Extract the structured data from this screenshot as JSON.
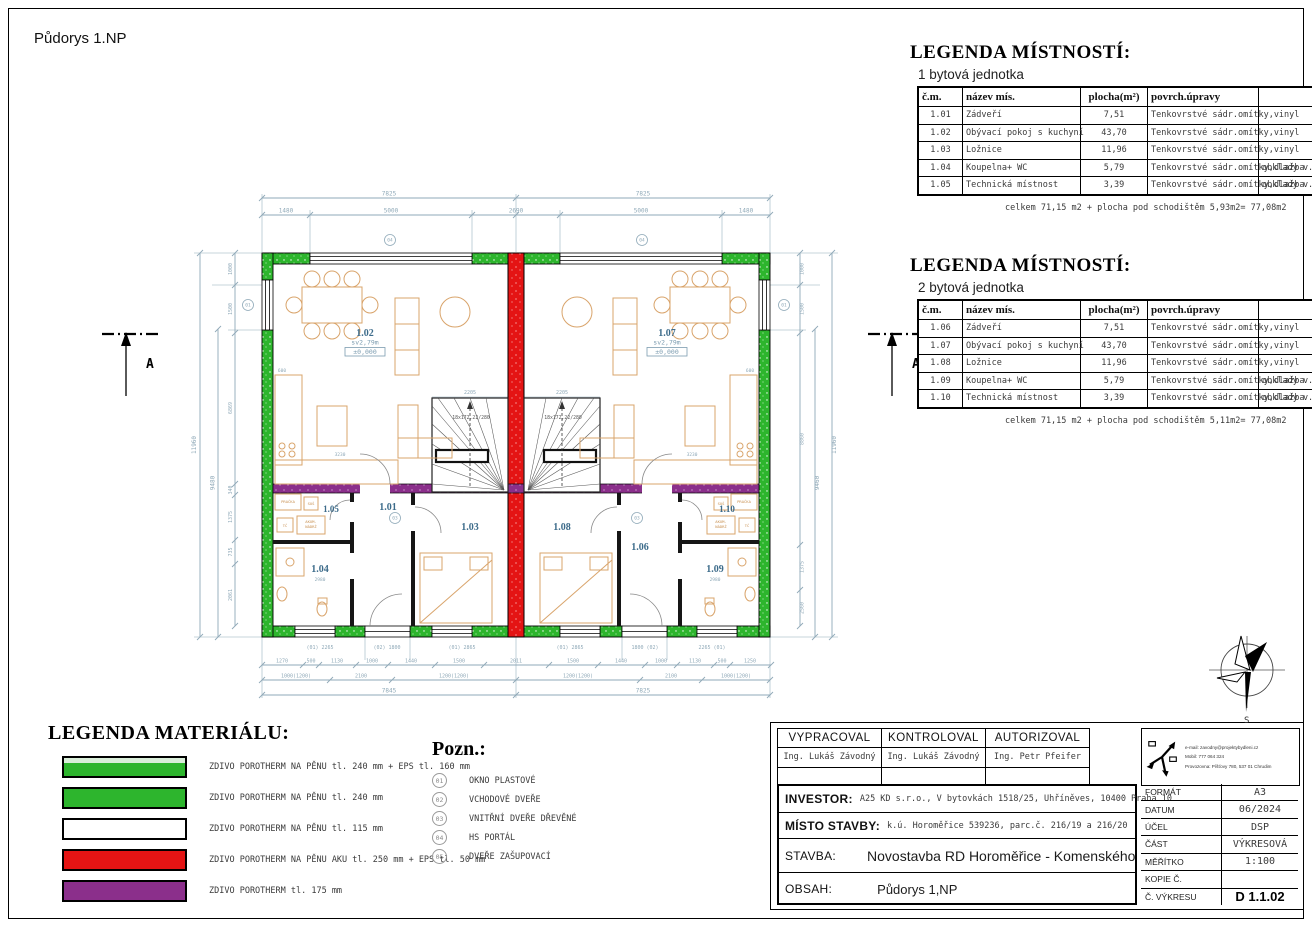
{
  "page": {
    "title": "Půdorys 1.NP"
  },
  "legend_rooms_1": {
    "title": "LEGENDA MÍSTNOSTÍ:",
    "subtitle": "1 bytová jednotka",
    "headers": [
      "č.m.",
      "název mís.",
      "plocha(m²)",
      "povrch.úpravy",
      ""
    ],
    "rows": [
      [
        "1.01",
        "Zádveří",
        "7,51",
        "Tenkovrstvé sádr.omítky,vinyl",
        ""
      ],
      [
        "1.02",
        "Obývací pokoj s kuchyní",
        "43,70",
        "Tenkovrstvé sádr.omítky,vinyl",
        ""
      ],
      [
        "1.03",
        "Ložnice",
        "11,96",
        "Tenkovrstvé sádr.omítky,vinyl",
        ""
      ],
      [
        "1.04",
        "Koupelna+ WC",
        "5,79",
        "Tenkovrstvé sádr.omítky,dlažba",
        "obklady v.2m"
      ],
      [
        "1.05",
        "Technická místnost",
        "3,39",
        "Tenkovrstvé sádr.omítky,dlažba",
        "obklady v.2m"
      ]
    ],
    "total": "celkem 71,15 m2 + plocha pod schodištěm 5,93m2= 77,08m2"
  },
  "legend_rooms_2": {
    "title": "LEGENDA MÍSTNOSTÍ:",
    "subtitle": "2 bytová jednotka",
    "headers": [
      "č.m.",
      "název mís.",
      "plocha(m²)",
      "povrch.úpravy",
      ""
    ],
    "rows": [
      [
        "1.06",
        "Zádveří",
        "7,51",
        "Tenkovrstvé sádr.omítky,vinyl",
        ""
      ],
      [
        "1.07",
        "Obývací pokoj s kuchyní",
        "43,70",
        "Tenkovrstvé sádr.omítky,vinyl",
        ""
      ],
      [
        "1.08",
        "Ložnice",
        "11,96",
        "Tenkovrstvé sádr.omítky,vinyl",
        ""
      ],
      [
        "1.09",
        "Koupelna+ WC",
        "5,79",
        "Tenkovrstvé sádr.omítky,dlažba",
        "obklady v.2m"
      ],
      [
        "1.10",
        "Technická místnost",
        "3,39",
        "Tenkovrstvé sádr.omítky,dlažba",
        "obklady v.2m"
      ]
    ],
    "total": "celkem 71,15 m2 + plocha pod schodištěm 5,11m2= 77,08m2"
  },
  "legend_materials": {
    "title": "LEGENDA MATERIÁLU:",
    "items": [
      {
        "color": "#2db52d",
        "eps_color": "#d9eed9",
        "label": "ZDIVO POROTHERM NA PĚNU tl. 240 mm + EPS tl. 160 mm"
      },
      {
        "color": "#2db52d",
        "label": "ZDIVO POROTHERM NA PĚNU tl. 240 mm"
      },
      {
        "color": "#ffffff",
        "label": "ZDIVO POROTHERM NA PĚNU tl. 115 mm"
      },
      {
        "color": "#e41414",
        "label": "ZDIVO POROTHERM NA PĚNU AKU tl. 250 mm + EPS tl. 50 mm"
      },
      {
        "color": "#8b2f8b",
        "label": "ZDIVO POROTHERM tl. 175 mm"
      }
    ]
  },
  "notes": {
    "title": "Pozn.:",
    "items": [
      {
        "num": "01",
        "label": "OKNO PLASTOVÉ"
      },
      {
        "num": "02",
        "label": "VCHODOVÉ DVEŘE"
      },
      {
        "num": "03",
        "label": "VNITŘNÍ DVEŘE DŘEVĚNÉ"
      },
      {
        "num": "04",
        "label": "HS PORTÁL"
      },
      {
        "num": "05",
        "label": "DVEŘE ZAŠUPOVACÍ"
      }
    ]
  },
  "title_block": {
    "vypracoval_label": "VYPRACOVAL",
    "vypracoval": "Ing. Lukáš Závodný",
    "kontroloval_label": "KONTROLOVAL",
    "kontroloval": "Ing. Lukáš Závodný",
    "autorizoval_label": "AUTORIZOVAL",
    "autorizoval": "Ing. Petr Pfeifer",
    "contact": {
      "email": "e-mail: zavodny@projektybydleni.cz",
      "mobil": "Mobil: 777 064 324",
      "provozovna": "Provozovna: Píšťovy 780, 537 01 Chrudim"
    },
    "investor_label": "INVESTOR:",
    "investor": "A25 KD s.r.o., V bytovkách 1518/25, Uhříněves, 10400 Praha 10",
    "misto_label": "MÍSTO STAVBY:",
    "misto": "k.ú. Horoměřice 539236, parc.č. 216/19 a 216/20",
    "stavba_label": "STAVBA:",
    "stavba": "Novostavba RD Horoměřice - Komenského",
    "obsah_label": "OBSAH:",
    "obsah": "Půdorys 1,NP",
    "fields": [
      {
        "label": "FORMÁT",
        "value": "A3"
      },
      {
        "label": "DATUM",
        "value": "06/2024"
      },
      {
        "label": "ÚČEL",
        "value": "DSP"
      },
      {
        "label": "ČÁST",
        "value": "VÝKRESOVÁ"
      },
      {
        "label": "MĚŘÍTKO",
        "value": "1:100"
      },
      {
        "label": "KOPIE Č.",
        "value": ""
      },
      {
        "label": "Č. VÝKRESU",
        "value": "D 1.1.02"
      }
    ]
  },
  "plan": {
    "colors": {
      "wall_green": "#2db52d",
      "wall_red": "#e41414",
      "wall_purple": "#8b2f8b",
      "dims": "#8fa9b8",
      "furniture": "#d9a46b",
      "room_label": "#3c6b8a"
    },
    "rooms": [
      "1.01",
      "1.02",
      "1.03",
      "1.04",
      "1.05",
      "1.06",
      "1.07",
      "1.08",
      "1.09",
      "1.10"
    ],
    "living": {
      "height": "sv2,79m",
      "level": "±0,000"
    },
    "stair_label": "18x172,22/280",
    "section_label": "A",
    "compass_label": "S",
    "markers": {
      "m01": "01",
      "m03": "03",
      "m04": "04"
    },
    "tech": [
      "PRAČKA",
      "SUŠ",
      "TČ",
      "AKUM.",
      "NÁDRŽ"
    ],
    "dims": {
      "top": [
        "7825",
        "7825"
      ],
      "top2": [
        "1480",
        "5000",
        "2690",
        "5000",
        "1480"
      ],
      "left": [
        "11960",
        "9480",
        "1000",
        "1500",
        "6869",
        "340",
        "1375",
        "735",
        "2061"
      ],
      "right": [
        "11960",
        "9460",
        "1000",
        "1500",
        "8860",
        "1375",
        "2560"
      ],
      "bottom1": [
        "(01) 2265",
        "(02) 1800",
        "(01) 2865",
        "(01) 2865",
        "1800 (02)",
        "2265 (01)"
      ],
      "bottom2": [
        "1270",
        "500",
        "1130",
        "1000",
        "1440",
        "1500",
        "2011",
        "1500",
        "1440",
        "1000",
        "1130",
        "500",
        "1250"
      ],
      "bottom3": [
        "1000(1200)",
        "2100",
        "1200(1200)",
        "1200(1200)",
        "2100",
        "1000(1200)"
      ],
      "bottom4": [
        "7845",
        "7825"
      ],
      "stair_width": [
        "2205",
        "2205"
      ],
      "kitchen": [
        "3230",
        "3230",
        "600",
        "600"
      ],
      "room_minor": [
        "2980",
        "2980"
      ]
    }
  }
}
